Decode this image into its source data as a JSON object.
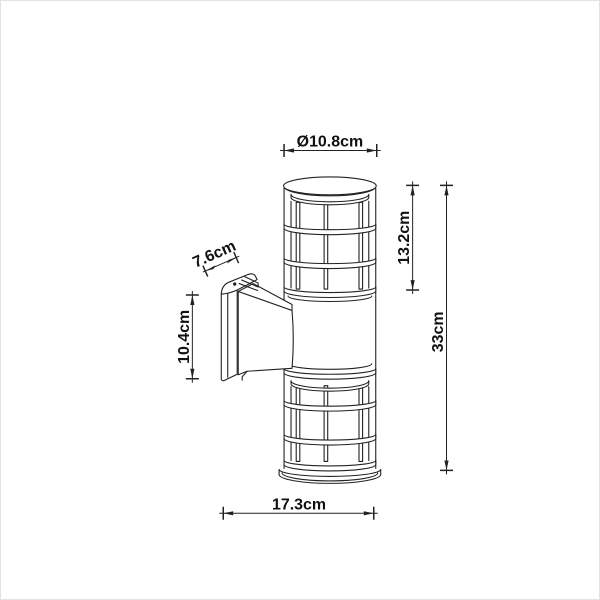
{
  "diagram": {
    "type": "product-dimension-drawing",
    "subject": "outdoor wall lamp with caged cylinder shade and wall bracket",
    "background": "#ffffff",
    "line_color": "#222222",
    "dimensions": {
      "diameter": "Ø10.8cm",
      "upper_height": "13.2cm",
      "total_height": "33cm",
      "arm_depth": "7.6cm",
      "plate_height": "10.4cm",
      "total_depth": "17.3cm"
    }
  }
}
